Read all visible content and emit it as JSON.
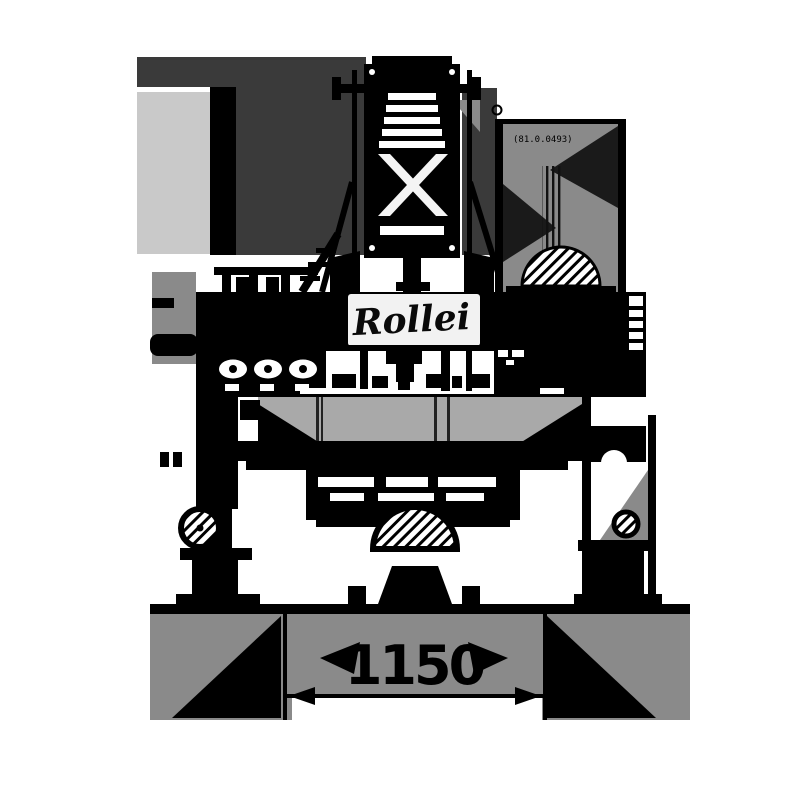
{
  "meta": {
    "description": "Black technical drawing (front elevation) of an industrial machine standing on a floor line, with an overall width dimension below",
    "view": "front elevation silhouette"
  },
  "palette": {
    "ink": "#000000",
    "charcoal": "#3a3a3a",
    "mid_gray": "#8a8a8a",
    "open_gray": "#a9a9a9",
    "light_gray": "#c9c9c9",
    "paper": "#ffffff"
  },
  "labels": {
    "logo": "Rollei",
    "part_number": "(81.0.0493)"
  },
  "dimension": {
    "width_value": "1150"
  }
}
